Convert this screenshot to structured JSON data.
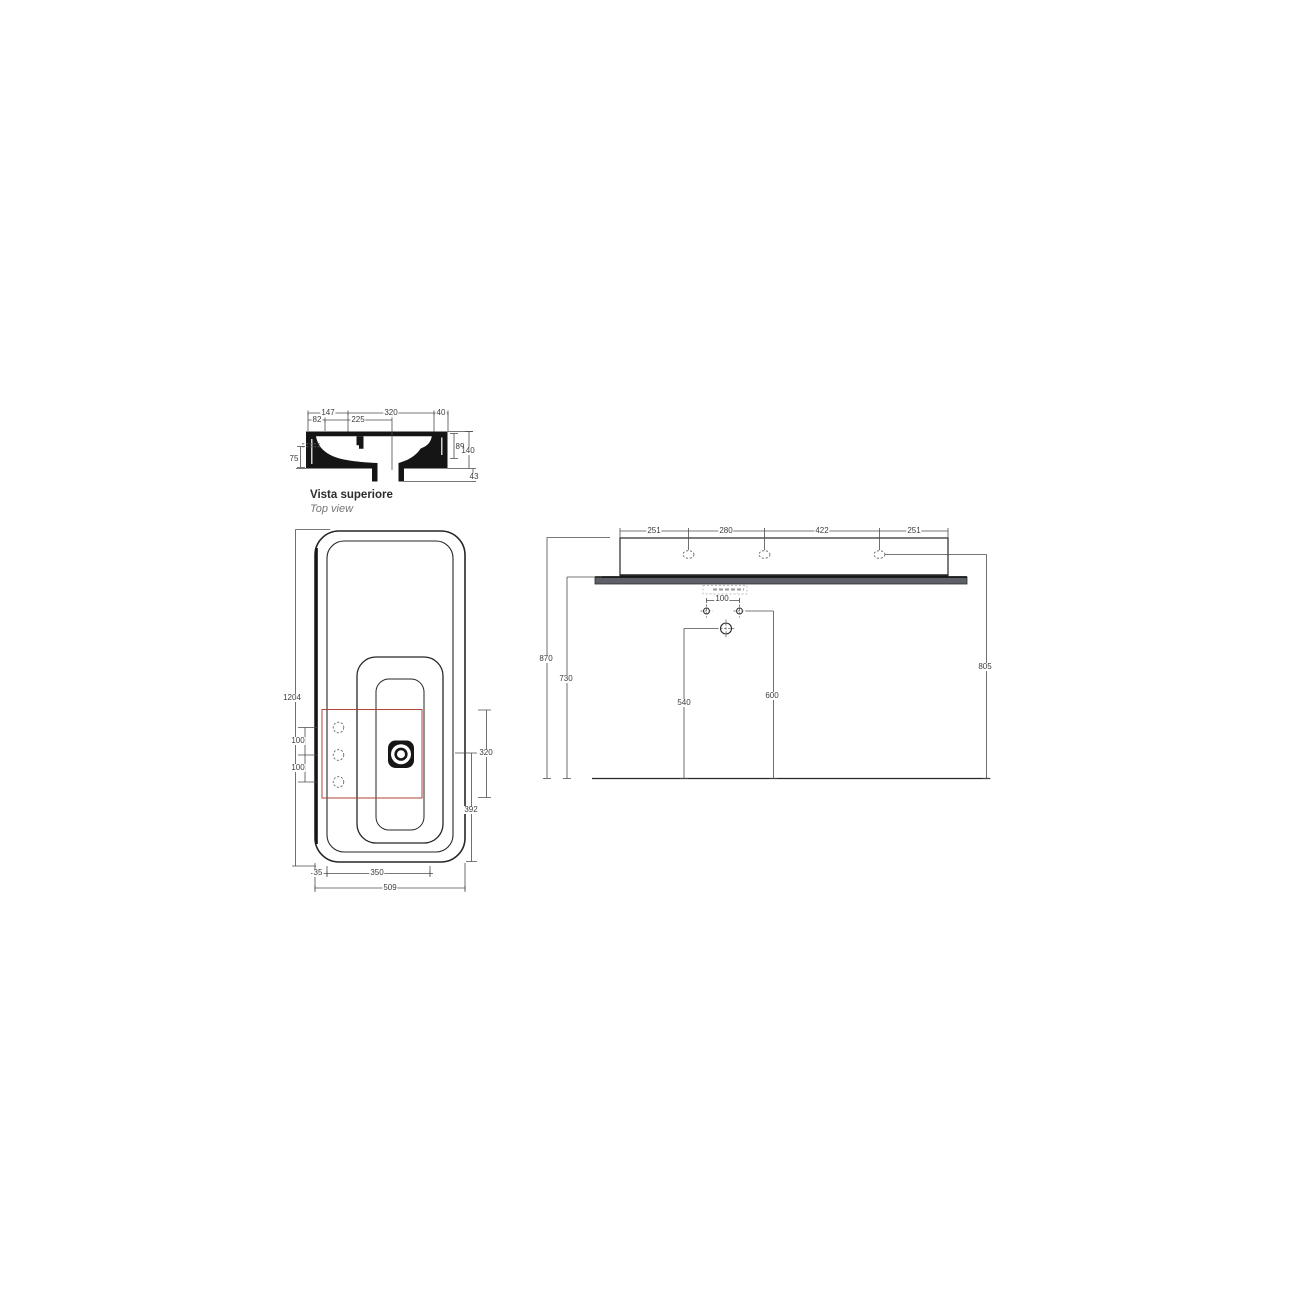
{
  "drawing_title": {
    "primary": "Vista superiore",
    "secondary": "Top view"
  },
  "colors": {
    "line": "#262626",
    "dimension": "#4c4c4c",
    "install_zone_red": "#b2443a",
    "shelf_gray": "#5d6167",
    "background": "#ffffff"
  },
  "section_view": {
    "top_row": [
      "147",
      "320",
      "40"
    ],
    "second_row": [
      "82",
      "225"
    ],
    "left_depth": "75",
    "right_inner": "89",
    "right_total": "140",
    "bottom_right": "43"
  },
  "plan_view": {
    "length_total": "1204",
    "hole_spacing": [
      "100",
      "100"
    ],
    "zone_width": "320",
    "drain_to_front": "392",
    "bottom_row": [
      "35",
      "350",
      "509"
    ]
  },
  "front_view": {
    "top_row": [
      "251",
      "280",
      "422",
      "251"
    ],
    "bracket_spacing": "100",
    "left_outer": "870",
    "left_inner": "730",
    "drain_height": "540",
    "bracket_height": "600",
    "right_height": "805"
  }
}
